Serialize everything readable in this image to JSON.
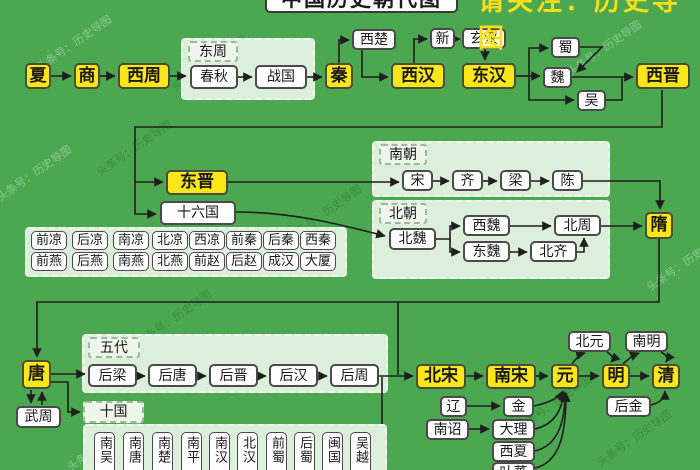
{
  "title": "中国历史朝代图",
  "subtitle": "请关注：历史导图",
  "watermark": "头条号：历史导图",
  "colors": {
    "background": "#4ba750",
    "highlight_box": "#fbe719",
    "plain_box": "#fdfdfd",
    "group_box": "#dcefda",
    "line": "#1f1f1f"
  },
  "nodes": {
    "xia": "夏",
    "shang": "商",
    "xizhou": "西周",
    "chunqiu": "春秋",
    "zhanguo": "战国",
    "qin": "秦",
    "xichu": "西楚",
    "xihan": "西汉",
    "xin": "新",
    "xuanhan": "玄汉",
    "donghan": "东汉",
    "shu": "蜀",
    "wei": "魏",
    "wu": "吴",
    "xijin": "西晋",
    "dongjin": "东晋",
    "shiliuguo": "十六国",
    "song": "宋",
    "qi": "齐",
    "liang": "梁",
    "chen": "陈",
    "beiwei": "北魏",
    "xiwei": "西魏",
    "dongwei": "东魏",
    "beizhou": "北周",
    "beiqi": "北齐",
    "sui": "隋",
    "tang": "唐",
    "wuzhou": "武周",
    "houliang": "后梁",
    "houtang": "后唐",
    "houjin": "后晋",
    "houhan": "后汉",
    "houzhou": "后周",
    "beisong": "北宋",
    "nansong": "南宋",
    "yuan": "元",
    "ming": "明",
    "qing": "清",
    "beiyuan": "北元",
    "nanming": "南明",
    "liao": "辽",
    "nanzhao": "南诏",
    "jinchao": "金",
    "dali": "大理",
    "xixia": "西夏",
    "tubo": "叶蕃",
    "houjinq": "后金"
  },
  "groups": {
    "dongzhou": "东周",
    "nanchao": "南朝",
    "beichao": "北朝",
    "wudai": "五代",
    "shiguo": "十国"
  },
  "sixteen_kingdoms": [
    "前凉",
    "后凉",
    "南凉",
    "北凉",
    "西凉",
    "前秦",
    "后秦",
    "西秦",
    "前燕",
    "后燕",
    "南燕",
    "北燕",
    "前赵",
    "后赵",
    "成汉",
    "大厦"
  ],
  "ten_kingdoms": [
    "南吴",
    "南唐",
    "南楚",
    "南平",
    "南汉",
    "北汉",
    "前蜀",
    "后蜀",
    "闽国",
    "吴越"
  ],
  "edges": [
    {
      "from": "夏",
      "to": "商"
    },
    {
      "from": "商",
      "to": "西周"
    },
    {
      "from": "西周",
      "to": "春秋"
    },
    {
      "from": "春秋",
      "to": "战国"
    },
    {
      "from": "战国",
      "to": "秦"
    },
    {
      "from": "秦",
      "to": "西楚"
    },
    {
      "from": "西楚",
      "to": "西汉"
    },
    {
      "from": "西汉",
      "to": "新"
    },
    {
      "from": "新",
      "to": "玄汉"
    },
    {
      "from": "玄汉",
      "to": "东汉"
    },
    {
      "from": "东汉",
      "to": "蜀"
    },
    {
      "from": "东汉",
      "to": "魏"
    },
    {
      "from": "东汉",
      "to": "吴"
    },
    {
      "from": "蜀",
      "to": "魏"
    },
    {
      "from": "魏",
      "to": "西晋"
    },
    {
      "from": "吴",
      "to": "西晋"
    },
    {
      "from": "西晋",
      "to": "东晋"
    },
    {
      "from": "西晋",
      "to": "十六国"
    },
    {
      "from": "东晋",
      "to": "宋"
    },
    {
      "from": "宋",
      "to": "齐"
    },
    {
      "from": "齐",
      "to": "梁"
    },
    {
      "from": "梁",
      "to": "陈"
    },
    {
      "from": "陈",
      "to": "隋"
    },
    {
      "from": "十六国",
      "to": "北魏"
    },
    {
      "from": "北魏",
      "to": "西魏"
    },
    {
      "from": "北魏",
      "to": "东魏"
    },
    {
      "from": "西魏",
      "to": "北周"
    },
    {
      "from": "东魏",
      "to": "北齐"
    },
    {
      "from": "北齐",
      "to": "北周"
    },
    {
      "from": "北周",
      "to": "隋"
    },
    {
      "from": "隋",
      "to": "唐"
    },
    {
      "from": "唐",
      "to": "武周"
    },
    {
      "from": "武周",
      "to": "唐"
    },
    {
      "from": "唐",
      "to": "后梁"
    },
    {
      "from": "唐",
      "to": "十国"
    },
    {
      "from": "后梁",
      "to": "后唐"
    },
    {
      "from": "后唐",
      "to": "后晋"
    },
    {
      "from": "后晋",
      "to": "后汉"
    },
    {
      "from": "后汉",
      "to": "后周"
    },
    {
      "from": "后周",
      "to": "北宋"
    },
    {
      "from": "北宋",
      "to": "南宋"
    },
    {
      "from": "南宋",
      "to": "元"
    },
    {
      "from": "元",
      "to": "明"
    },
    {
      "from": "明",
      "to": "清"
    },
    {
      "from": "元",
      "to": "北元"
    },
    {
      "from": "北元",
      "to": "明"
    },
    {
      "from": "明",
      "to": "南明"
    },
    {
      "from": "南明",
      "to": "清"
    },
    {
      "from": "辽",
      "to": "金"
    },
    {
      "from": "南诏",
      "to": "大理"
    },
    {
      "from": "金",
      "to": "元"
    },
    {
      "from": "大理",
      "to": "元"
    },
    {
      "from": "西夏",
      "to": "元"
    },
    {
      "from": "叶蕃",
      "to": "元"
    },
    {
      "from": "后金",
      "to": "清"
    }
  ]
}
